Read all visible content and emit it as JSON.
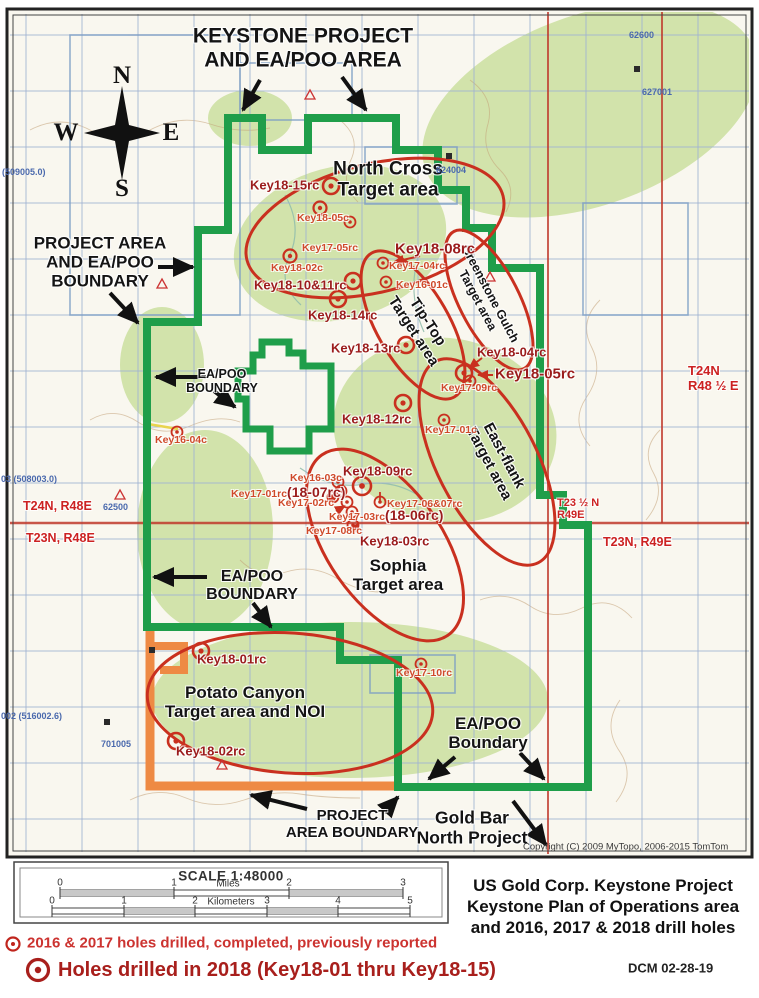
{
  "map": {
    "title": [
      "KEYSTONE PROJECT",
      "AND EA/POO AREA"
    ],
    "compass": {
      "n": "N",
      "w": "W",
      "e": "E",
      "s": "S"
    },
    "boundary_labels": {
      "project_area_eapoo": [
        "PROJECT AREA",
        "AND EA/POO",
        "BOUNDARY"
      ],
      "eapoo_inner": [
        "EA/POO",
        "BOUNDARY"
      ],
      "eapoo_lower": [
        "EA/POO",
        "BOUNDARY"
      ],
      "eapoo_bottom_right": [
        "EA/POO",
        "Boundary"
      ],
      "project_area_bottom": [
        "PROJECT",
        "AREA BOUNDARY"
      ],
      "gold_bar": [
        "Gold Bar",
        "North Project"
      ]
    },
    "target_areas": {
      "north_cross": [
        "North Cross",
        "Target area"
      ],
      "tip_top": [
        "Tip-Top",
        "Target area"
      ],
      "greenstone": [
        "Greenstone Gulch",
        "Target area"
      ],
      "east_flank": [
        "East-flank",
        "Target area"
      ],
      "sophia": [
        "Sophia",
        "Target area"
      ],
      "potato": [
        "Potato Canyon",
        "Target area and NOI"
      ]
    },
    "holes": {
      "k18_15": "Key18-15rc",
      "k18_05c": "Key18-05c",
      "k17_05": "Key17-05rc",
      "k18_08": "Key18-08rc",
      "k17_04": "Key17-04rc",
      "k16_01c": "Key16-01c",
      "k18_02c": "Key18-02c",
      "k18_1011": "Key18-10&11rc",
      "k18_14": "Key18-14rc",
      "k18_13": "Key18-13rc",
      "k18_04": "Key18-04rc",
      "k18_05rc": "Key18-05rc",
      "k17_09": "Key17-09rc",
      "k18_12": "Key18-12rc",
      "k17_01c": "Key17-01c",
      "k16_04c": "Key16-04c",
      "k18_09": "Key18-09rc",
      "k16_03c": "Key16-03c",
      "k17_01rc": "Key17-01rc",
      "k18_07rc": "(18-07rc)",
      "k17_02": "Key17-02rc",
      "k17_0607": "Key17-06&07rc",
      "k17_03": "Key17-03rc",
      "k18_06rc": "(18-06rc)",
      "k17_08": "Key17-08rc",
      "k18_03": "Key18-03rc",
      "k17_10": "Key17-10rc",
      "k18_01": "Key18-01rc",
      "k18_02rc": "Key18-02rc"
    },
    "grid_labels": {
      "blue": {
        "b1": "(509005.0)",
        "b2": "624004",
        "b3": "62600",
        "b4": "627001",
        "b5": "62500",
        "b6": "03 (508003.0)",
        "b7": "002 (516002.6)",
        "b8": "701005"
      },
      "red": {
        "t24n_r48e": "T24N, R48E",
        "t23n_r48e": "T23N, R48E",
        "t24n": "T24N",
        "r48half": "R48 ½ E",
        "t23half": "T23 ½ N",
        "r49e": "R49E",
        "t23n_r49e": "T23N, R49E"
      }
    },
    "copyright": "Copyright (C) 2009 MyTopo, 2006-2015 TomTom"
  },
  "scale_bar": {
    "title": "SCALE 1:48000",
    "miles_label": "Miles",
    "miles_ticks": [
      "0",
      "1",
      "2",
      "3"
    ],
    "km_label": "Kilometers",
    "km_ticks": [
      "0",
      "1",
      "2",
      "3",
      "4",
      "5"
    ]
  },
  "legend": {
    "item_2016_2017": "2016 & 2017 holes drilled, completed, previously reported",
    "item_2018": "Holes drilled in 2018 (Key18-01 thru Key18-15)"
  },
  "caption": {
    "lines": [
      "US Gold Corp. Keystone Project",
      "Keystone Plan of Operations area",
      "and 2016, 2017 & 2018 drill holes"
    ],
    "credit": "DCM  02-28-19"
  },
  "colors": {
    "boundary_green": "#1f9e4a",
    "noi_orange": "#ee8a44",
    "target_red": "#c9301f",
    "hole_2018_label": "#9b1c1c",
    "hole_2017_label": "#cf4a2a",
    "township_red": "#cc2222",
    "grid_blue": "#9fb2d2"
  }
}
